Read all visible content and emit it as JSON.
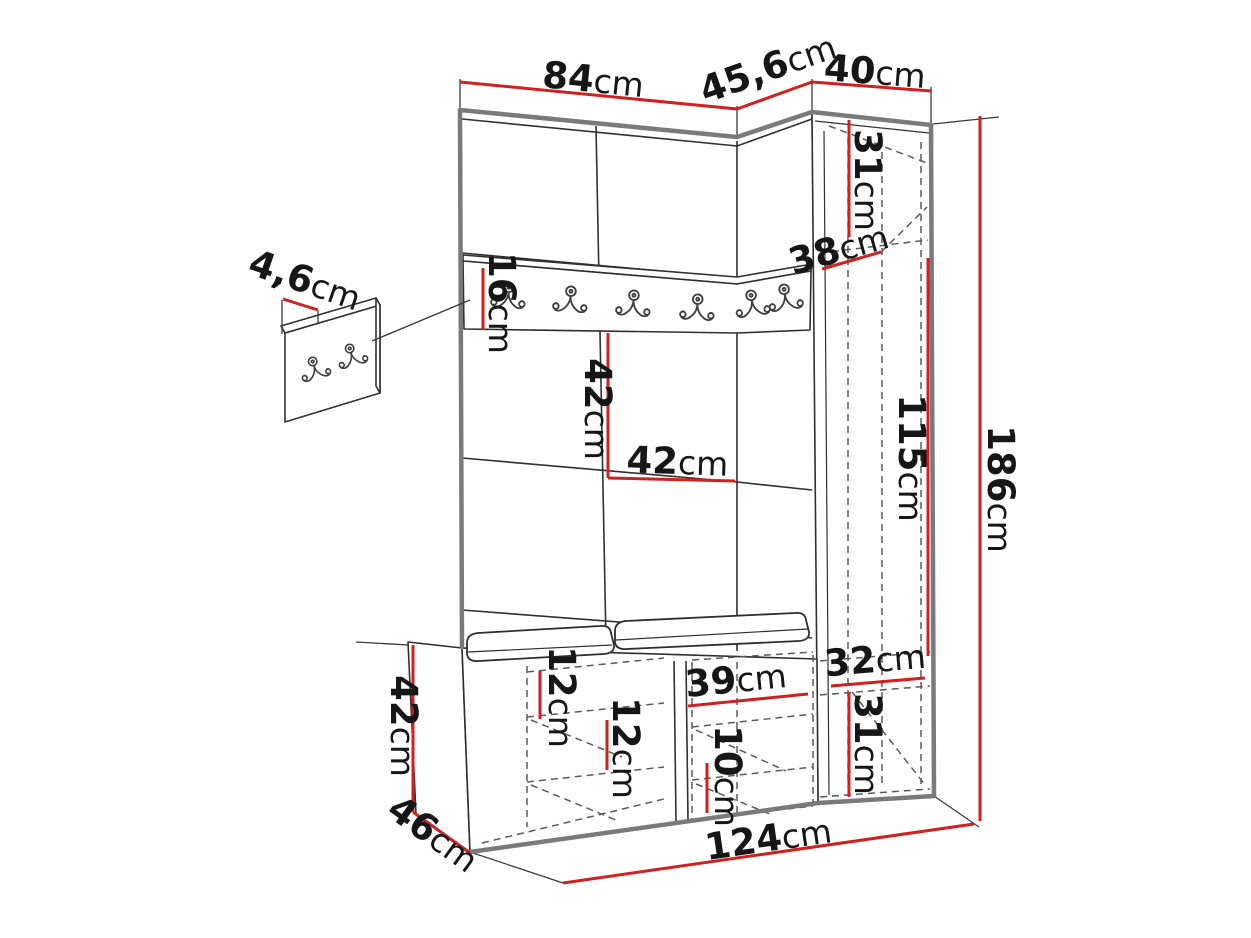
{
  "diagram_kind": "furniture-dimension-drawing",
  "colors": {
    "dimension_red": "#d02020",
    "outline_gray": "#7a7a7a",
    "line_dark": "#303030",
    "dashed_gray": "#5a5a5a",
    "label_black": "#161616",
    "background": "#ffffff"
  },
  "icons": {
    "coat_hook": "double-coat-hook-icon"
  },
  "dims": {
    "main_width": {
      "num": "84",
      "unit": "cm"
    },
    "corner_width": {
      "num": "45,6",
      "unit": "cm"
    },
    "cabinet_width": {
      "num": "40",
      "unit": "cm"
    },
    "hook_panel_depth": {
      "num": "4,6",
      "unit": "cm"
    },
    "rail_height": {
      "num": "16",
      "unit": "cm"
    },
    "cabinet_top_compartment_height": {
      "num": "31",
      "unit": "cm"
    },
    "cabinet_depth": {
      "num": "38",
      "unit": "cm"
    },
    "niche_height": {
      "num": "42",
      "unit": "cm"
    },
    "niche_width": {
      "num": "42",
      "unit": "cm"
    },
    "cabinet_inner_height": {
      "num": "115",
      "unit": "cm"
    },
    "total_height": {
      "num": "186",
      "unit": "cm"
    },
    "bench_top_clearance": {
      "num": "12",
      "unit": "cm"
    },
    "bench_shelf_clearance": {
      "num": "12",
      "unit": "cm"
    },
    "bench_compartment_width": {
      "num": "39",
      "unit": "cm"
    },
    "bench_lower_clearance": {
      "num": "10",
      "unit": "cm"
    },
    "cabinet_bottom_width": {
      "num": "32",
      "unit": "cm"
    },
    "cabinet_bottom_height": {
      "num": "31",
      "unit": "cm"
    },
    "bench_height": {
      "num": "42",
      "unit": "cm"
    },
    "bench_depth": {
      "num": "46",
      "unit": "cm"
    },
    "total_width": {
      "num": "124",
      "unit": "cm"
    }
  }
}
